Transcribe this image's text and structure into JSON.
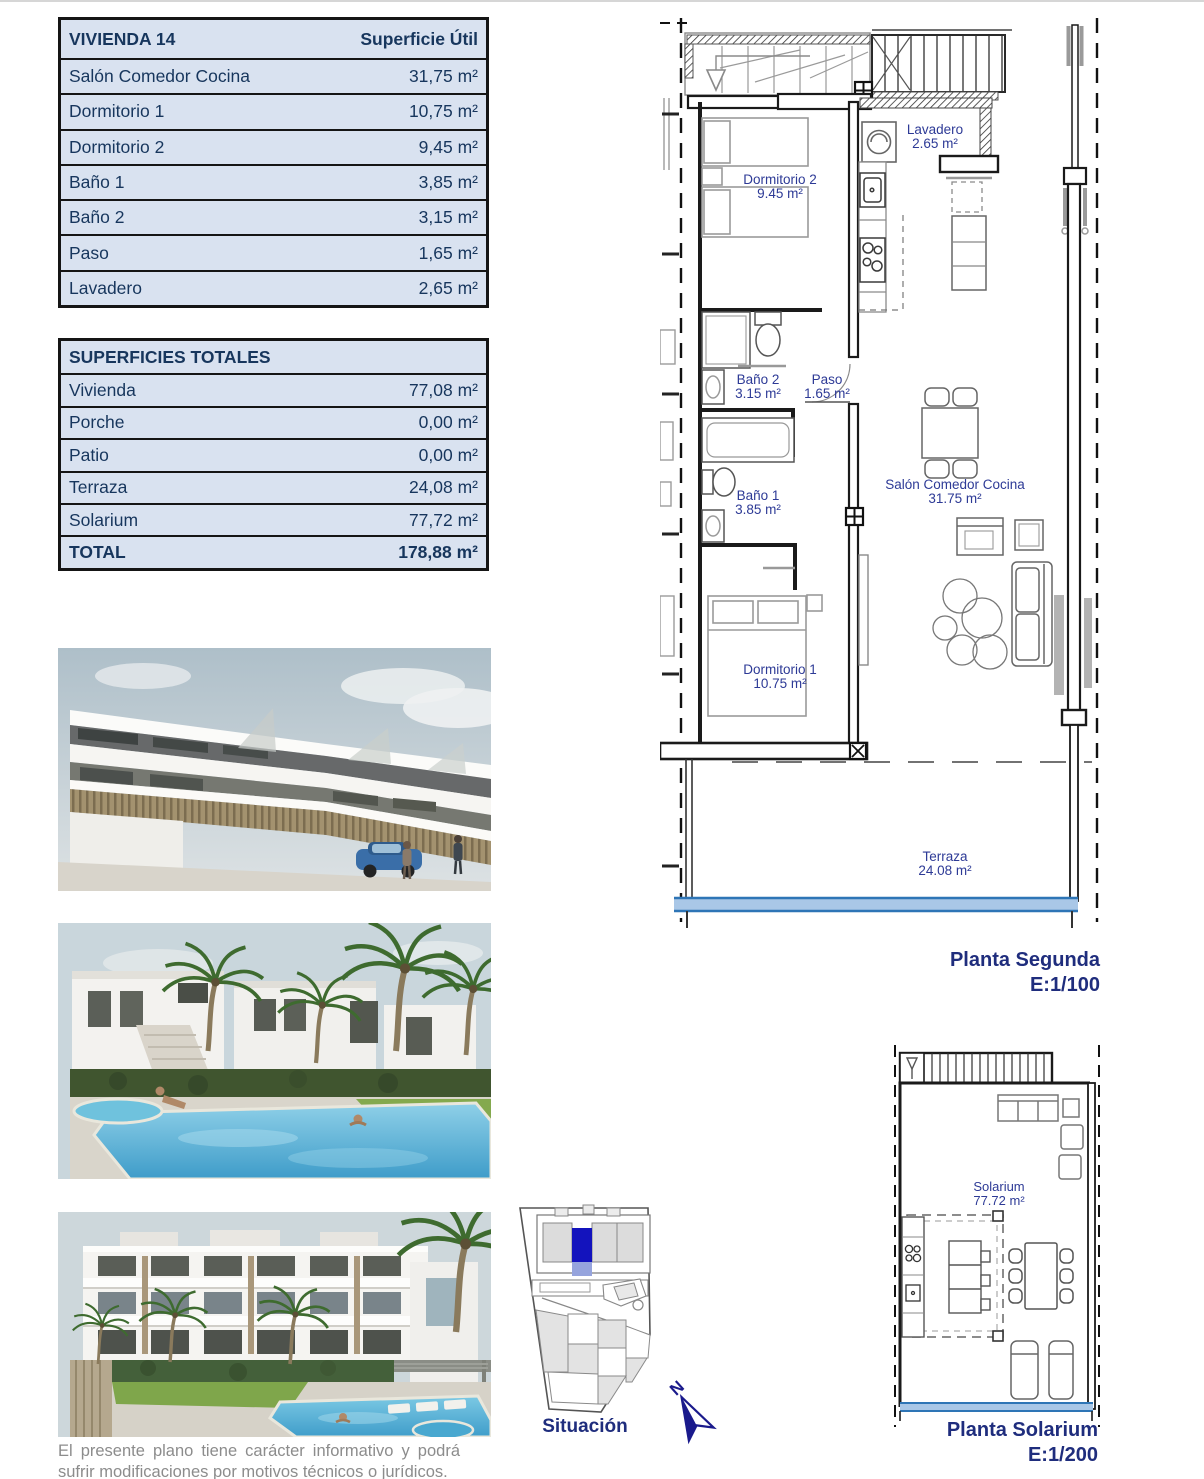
{
  "tables": {
    "vivienda": {
      "title": "VIVIENDA 14",
      "header_value": "Superficie Útil",
      "rows": [
        {
          "label": "Salón Comedor Cocina",
          "value": "31,75 m²"
        },
        {
          "label": "Dormitorio 1",
          "value": "10,75 m²"
        },
        {
          "label": "Dormitorio 2",
          "value": "9,45 m²"
        },
        {
          "label": "Baño 1",
          "value": "3,85 m²"
        },
        {
          "label": "Baño 2",
          "value": "3,15 m²"
        },
        {
          "label": "Paso",
          "value": "1,65 m²"
        },
        {
          "label": "Lavadero",
          "value": "2,65 m²"
        }
      ]
    },
    "totales": {
      "title": "SUPERFICIES TOTALES",
      "rows": [
        {
          "label": "Vivienda",
          "value": "77,08 m²"
        },
        {
          "label": "Porche",
          "value": "0,00 m²"
        },
        {
          "label": "Patio",
          "value": "0,00 m²"
        },
        {
          "label": "Terraza",
          "value": "24,08 m²"
        },
        {
          "label": "Solarium",
          "value": "77,72 m²"
        }
      ],
      "total": {
        "label": "TOTAL",
        "value": "178,88 m²"
      }
    }
  },
  "plan_segunda": {
    "title": "Planta Segunda",
    "scale": "E:1/100",
    "rooms": {
      "lavadero": {
        "name": "Lavadero",
        "area": "2.65 m²"
      },
      "dormitorio2": {
        "name": "Dormitorio 2",
        "area": "9.45 m²"
      },
      "bano2": {
        "name": "Baño 2",
        "area": "3.15 m²"
      },
      "paso": {
        "name": "Paso",
        "area": "1.65 m²"
      },
      "bano1": {
        "name": "Baño 1",
        "area": "3.85 m²"
      },
      "dormitorio1": {
        "name": "Dormitorio 1",
        "area": "10.75 m²"
      },
      "salon": {
        "name": "Salón Comedor Cocina",
        "area": "31.75 m²"
      },
      "terraza": {
        "name": "Terraza",
        "area": "24.08 m²"
      }
    }
  },
  "plan_solarium": {
    "title": "Planta Solarium",
    "scale": "E:1/200",
    "rooms": {
      "solarium": {
        "name": "Solarium",
        "area": "77.72 m²"
      }
    }
  },
  "situacion": {
    "label": "Situación",
    "north_letter": "N"
  },
  "disclaimer": "El presente plano tiene carácter informativo y podrá sufrir modificaciones por motivos técnicos o jurídicos.",
  "colors": {
    "table_bg": "#d9e2f0",
    "table_text": "#17365d",
    "plan_label": "#2d3a96",
    "plan_title": "#1f2d7d",
    "balustrade": "#a9c7e7",
    "balustrade_edge": "#2e75b6",
    "site_highlight": "#1313bd",
    "site_highlight_light": "#96a4dd",
    "disclaimer_text": "#8c8c8c"
  }
}
